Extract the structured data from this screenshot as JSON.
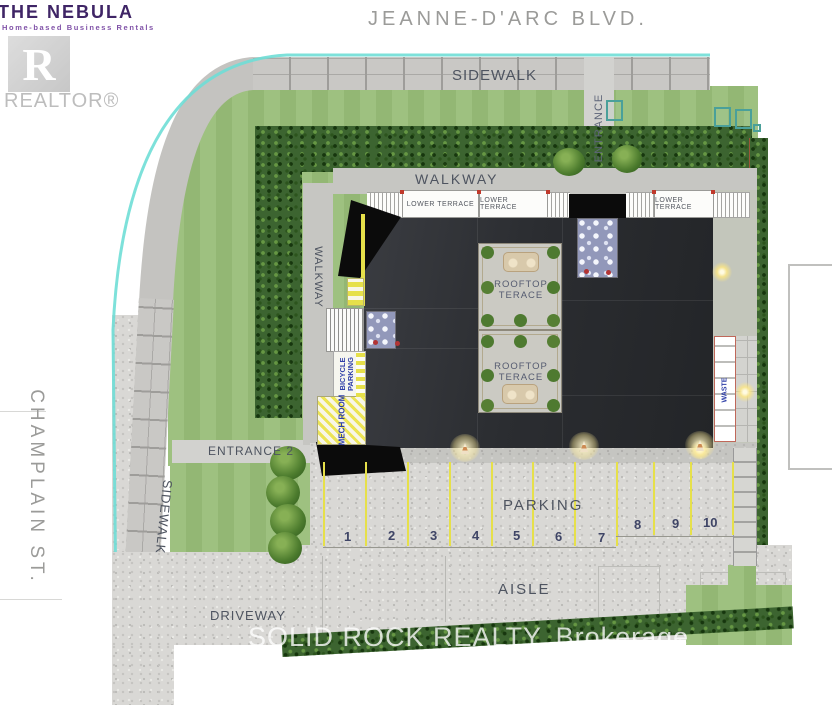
{
  "brand": {
    "title": "THE NEBULA",
    "tagline": "Home-based Business Rentals",
    "realtor_letter": "R",
    "realtor_label": "REALTOR®"
  },
  "streets": {
    "top": "JEANNE-D'ARC  BLVD.",
    "left": "CHAMPLAIN  ST."
  },
  "labels": {
    "sidewalk_top": "SIDEWALK",
    "sidewalk_left": "SIDEWALK",
    "walkway_top": "WALKWAY",
    "walkway_left": "WALKWAY",
    "entrance_top": "ENTRANCE",
    "entrance_2": "ENTRANCE 2",
    "driveway": "DRIVEWAY",
    "parking": "PARKING",
    "aisle": "AISLE"
  },
  "building": {
    "lower_terraces": [
      "LOWER TERRACE",
      "LOWER TERRACE",
      "LOWER TERRACE"
    ],
    "rooftop_terraces": [
      {
        "line1": "ROOFTOP",
        "line2": "TERACE"
      },
      {
        "line1": "ROOFTOP",
        "line2": "TERACE"
      }
    ],
    "bicycle_parking_line1": "BICYCLE",
    "bicycle_parking_line2": "PARKING",
    "mech_room": "MECH ROOM",
    "waste": "WASTE"
  },
  "parking_spaces": [
    "1",
    "2",
    "3",
    "4",
    "5",
    "6",
    "7",
    "8",
    "9",
    "10"
  ],
  "watermark": "SOLID ROCK REALTY, Brokerage",
  "colors": {
    "lawn": "#98bd78",
    "hedge": "#3c6430",
    "gravel": "#d9d8d5",
    "brick": "#c9c8c5",
    "roof": "#2b2d31",
    "roof_black": "#0b0b0b",
    "curb": "#6fded6",
    "yellow": "#e6e04a",
    "label": "#4e5460",
    "street": "#9b9b99",
    "number": "#3f4566",
    "blueprint_blue": "#2f3fa8",
    "stair_blue": "#9298ba",
    "terrace": "#cbcac3",
    "purple": "#3f2566",
    "purple_light": "#8052a8"
  }
}
